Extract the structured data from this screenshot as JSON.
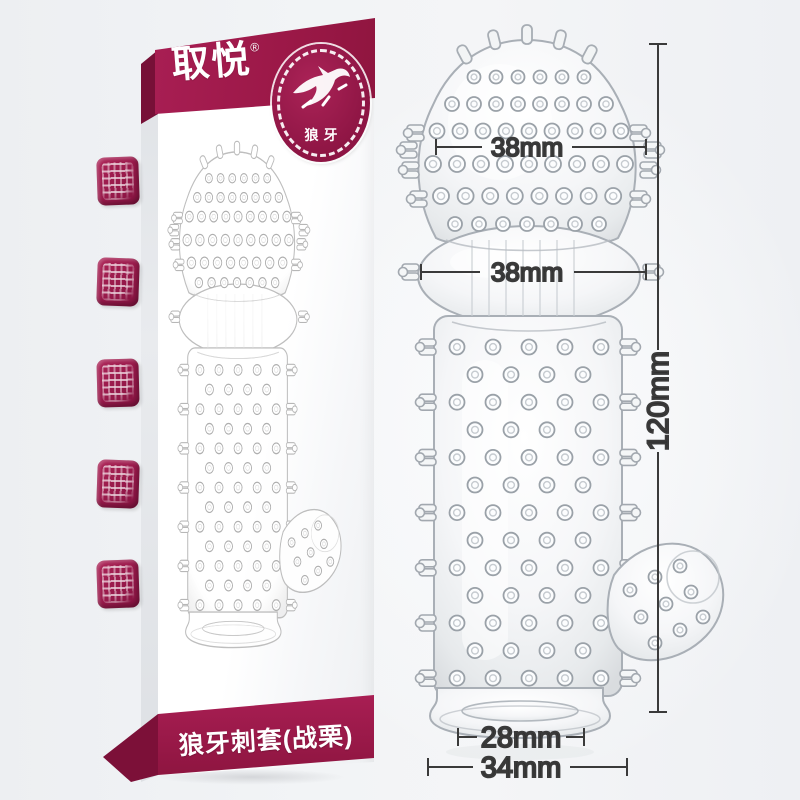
{
  "box": {
    "brand": "取悦",
    "reg_mark": "®",
    "badge": {
      "label": "狼牙",
      "icon": "wolf-icon"
    },
    "bottom_banner_label": "狼牙刺套(战栗)",
    "side_seal_icons": [
      "seal-stamp-icon",
      "seal-stamp-icon",
      "seal-stamp-icon",
      "seal-stamp-icon",
      "seal-stamp-icon"
    ]
  },
  "dimensions": {
    "head_diameter": "38mm",
    "bulb_diameter": "38mm",
    "total_length": "120mm",
    "opening_diameter": "28mm",
    "base_diameter": "34mm"
  },
  "colors": {
    "banner_maroon": "#9e1c4e",
    "banner_maroon_dark": "#7c1038",
    "dimension_line": "#3a3a3a",
    "background": "#eef0f3"
  }
}
